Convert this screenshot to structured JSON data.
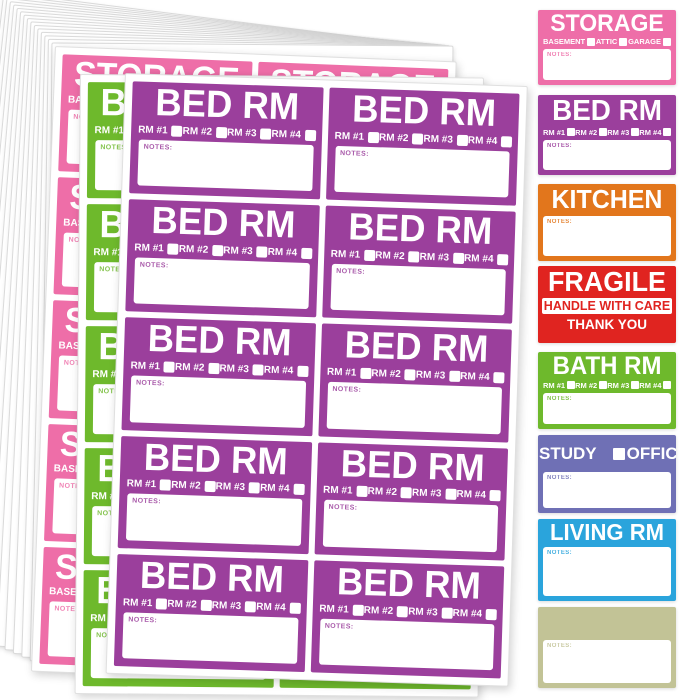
{
  "colors": {
    "pink": "#ee6ea8",
    "purple": "#9b3f9c",
    "green": "#6eb92c",
    "orange": "#e2761c",
    "red": "#e02420",
    "slate_blue": "#6f70b5",
    "sky_blue": "#2aa4dc",
    "tan": "#c2c396",
    "paper": "#ffffff"
  },
  "sheet_stack": {
    "count": 16
  },
  "sheets": {
    "storage": {
      "id": "storage",
      "title": "STORAGE",
      "color": "#ee6ea8",
      "checkboxes": [
        "BASEMENT",
        "ATTIC",
        "GARAGE"
      ],
      "notes_label": "NOTES:",
      "rows": 5,
      "cols": 2
    },
    "bath": {
      "id": "bath-rm",
      "title": "BATH RM",
      "color": "#6eb92c",
      "checkboxes": [
        "RM #1",
        "RM #2",
        "RM #3",
        "RM #4"
      ],
      "notes_label": "NOTES:",
      "rows": 5,
      "cols": 2
    },
    "bed": {
      "id": "bed-rm",
      "title": "BED RM",
      "color": "#9b3f9c",
      "checkboxes": [
        "RM #1",
        "RM #2",
        "RM #3",
        "RM #4"
      ],
      "notes_label": "NOTES:",
      "rows": 5,
      "cols": 2
    }
  },
  "sample_labels": [
    {
      "id": "storage",
      "title": "STORAGE",
      "color": "#ee6ea8",
      "checkboxes": [
        "BASEMENT",
        "ATTIC",
        "GARAGE"
      ],
      "notes_label": "NOTES:"
    },
    {
      "id": "bed-rm",
      "title": "BED RM",
      "color": "#9b3f9c",
      "checkboxes": [
        "RM #1",
        "RM #2",
        "RM #3",
        "RM #4"
      ],
      "notes_label": "NOTES:"
    },
    {
      "id": "kitchen",
      "title": "KITCHEN",
      "color": "#e2761c",
      "notes_label": "NOTES:"
    },
    {
      "id": "fragile",
      "title": "FRAGILE",
      "color": "#e02420",
      "line2": "HANDLE WITH CARE",
      "line3": "THANK YOU"
    },
    {
      "id": "bath-rm",
      "title": "BATH RM",
      "color": "#6eb92c",
      "checkboxes": [
        "RM #1",
        "RM #2",
        "RM #3",
        "RM #4"
      ],
      "notes_label": "NOTES:"
    },
    {
      "id": "study-office",
      "color": "#6f70b5",
      "options": [
        "STUDY",
        "OFFICE"
      ],
      "notes_label": "NOTES:"
    },
    {
      "id": "living-rm",
      "title": "LIVING RM",
      "color": "#2aa4dc",
      "notes_label": "NOTES:"
    },
    {
      "id": "blank",
      "title": "",
      "color": "#c2c396",
      "notes_label": "NOTES:"
    }
  ]
}
